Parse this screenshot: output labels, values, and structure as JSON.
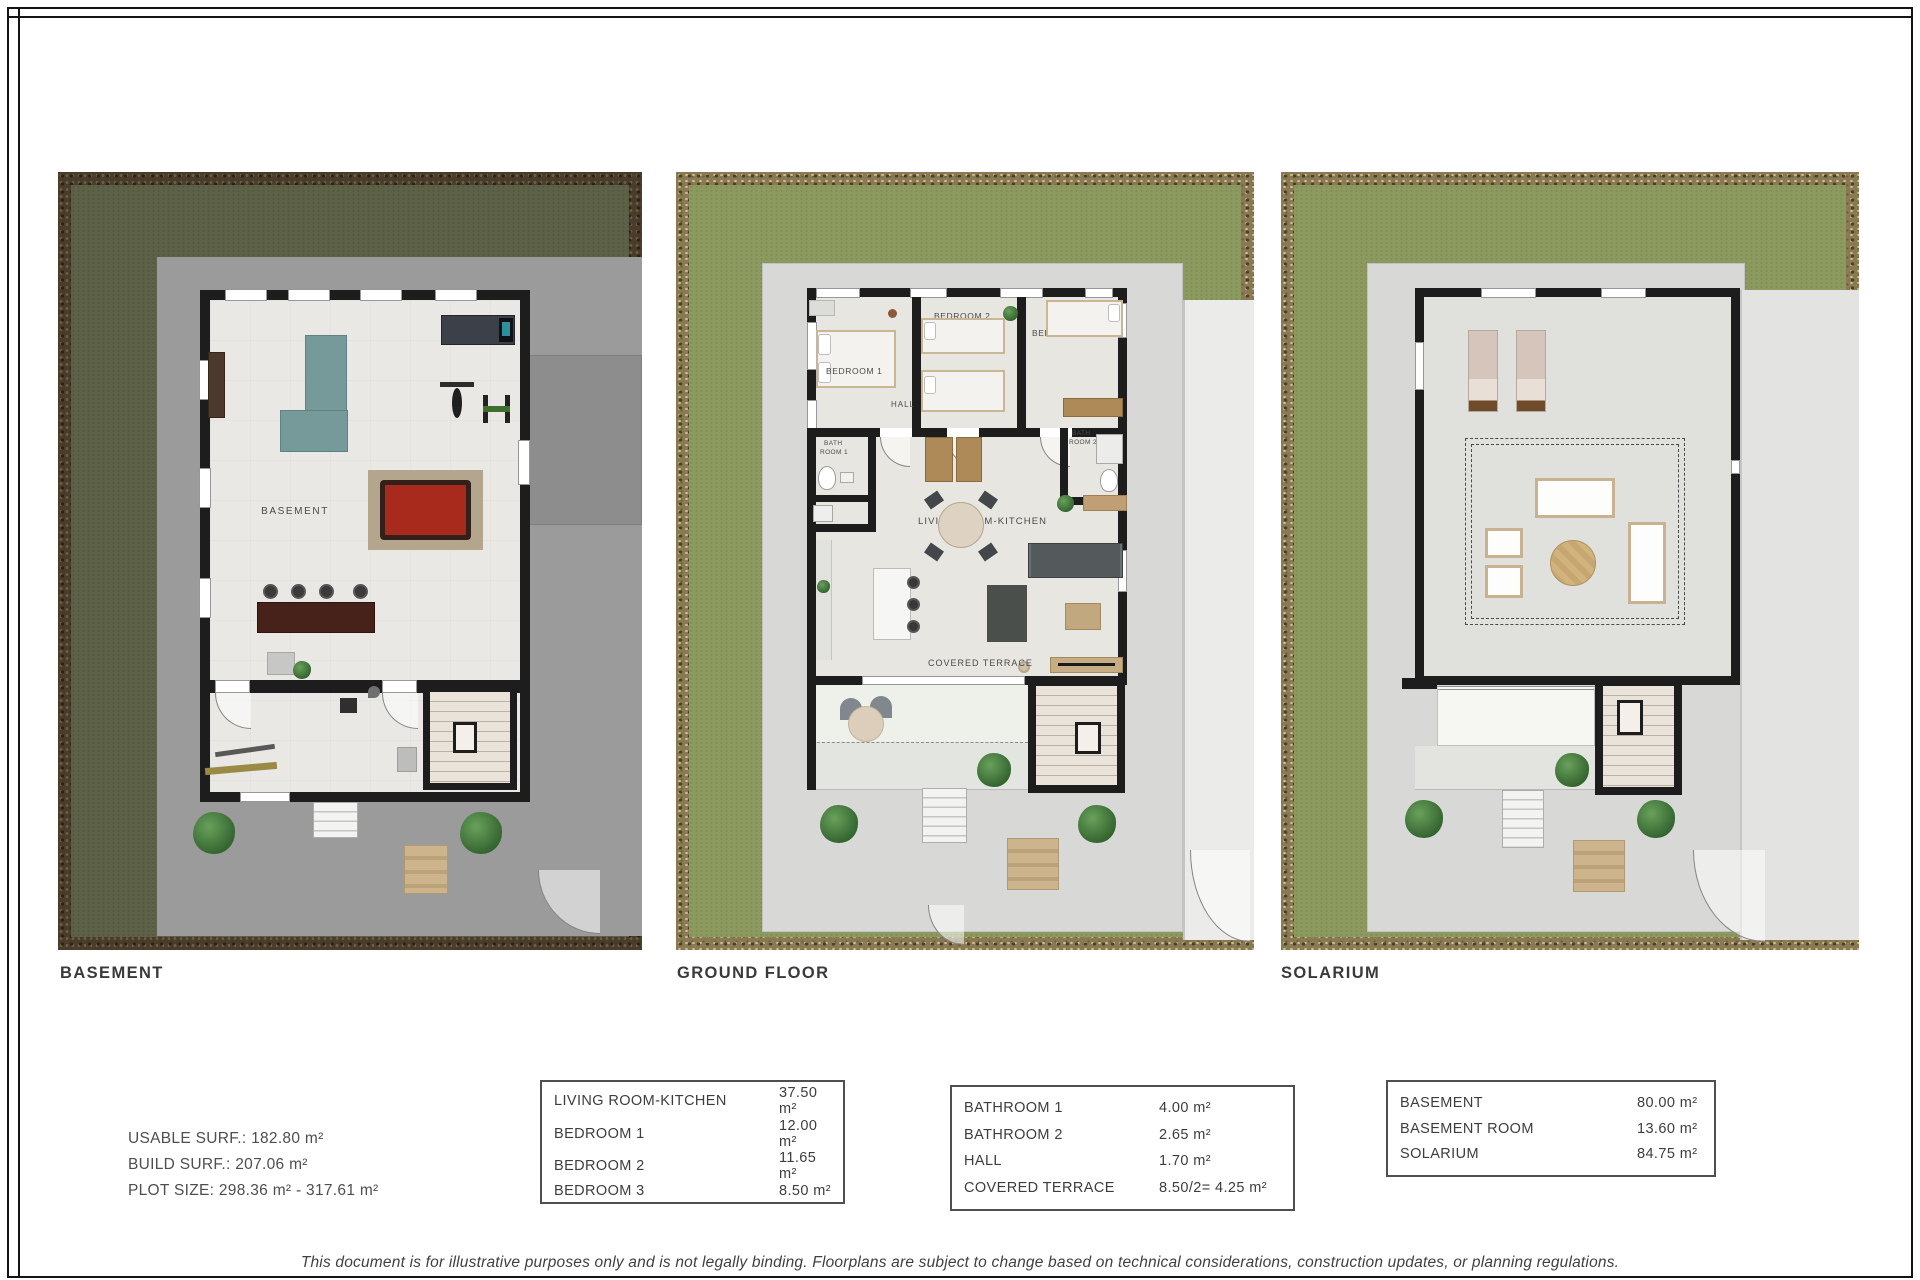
{
  "plans": [
    {
      "title": "BASEMENT",
      "rooms": {
        "basement": "BASEMENT"
      }
    },
    {
      "title": "GROUND FLOOR",
      "rooms": {
        "bedroom1": "BEDROOM 1",
        "bedroom2": "BEDROOM 2",
        "bedroom3": "BEDROOM 3",
        "hall": "HALL",
        "bath1_line1": "BATH",
        "bath1_line2": "ROOM 1",
        "bath2_line1": "BATH",
        "bath2_line2": "ROOM 2",
        "living": "LIVING ROOM-KITCHEN",
        "terrace": "COVERED TERRACE"
      }
    },
    {
      "title": "SOLARIUM",
      "rooms": {}
    }
  ],
  "summary": {
    "line1": "USABLE SURF.: 182.80 m²",
    "line2": "BUILD SURF.: 207.06 m²",
    "line3": "PLOT SIZE: 298.36 m² - 317.61 m²"
  },
  "tables": [
    {
      "rows": [
        {
          "label": "LIVING ROOM-KITCHEN",
          "value": "37.50 m²"
        },
        {
          "label": "BEDROOM 1",
          "value": "12.00 m²"
        },
        {
          "label": "BEDROOM 2",
          "value": "11.65 m²"
        },
        {
          "label": "BEDROOM 3",
          "value": "8.50 m²"
        }
      ]
    },
    {
      "rows": [
        {
          "label": "BATHROOM 1",
          "value": "4.00 m²"
        },
        {
          "label": "BATHROOM 2",
          "value": "2.65 m²"
        },
        {
          "label": "HALL",
          "value": "1.70 m²"
        },
        {
          "label": "COVERED TERRACE",
          "value": "8.50/2= 4.25 m²"
        }
      ]
    },
    {
      "rows": [
        {
          "label": "BASEMENT",
          "value": "80.00 m²"
        },
        {
          "label": "BASEMENT ROOM",
          "value": "13.60 m²"
        },
        {
          "label": "SOLARIUM",
          "value": "84.75 m²"
        }
      ]
    }
  ],
  "disclaimer": "This document is for illustrative purposes only and is not legally binding. Floorplans are subject to change based on technical considerations, construction updates, or planning regulations.",
  "palette": {
    "grass_dark": "#5c6147",
    "grass_light": "#8c9a60",
    "soil_dark": "#4a3c2b",
    "soil_light": "#8a7a52",
    "concrete": "#9b9b9b",
    "path_gray": "#d8d8d6",
    "wall_black": "#1d1d1d",
    "floor_light": "#e9e8e4",
    "pool_table_red": "#a82a1d",
    "sofa_teal": "#76999a",
    "wood_tan": "#c2a87e",
    "text_dark": "#3a3a3a"
  }
}
